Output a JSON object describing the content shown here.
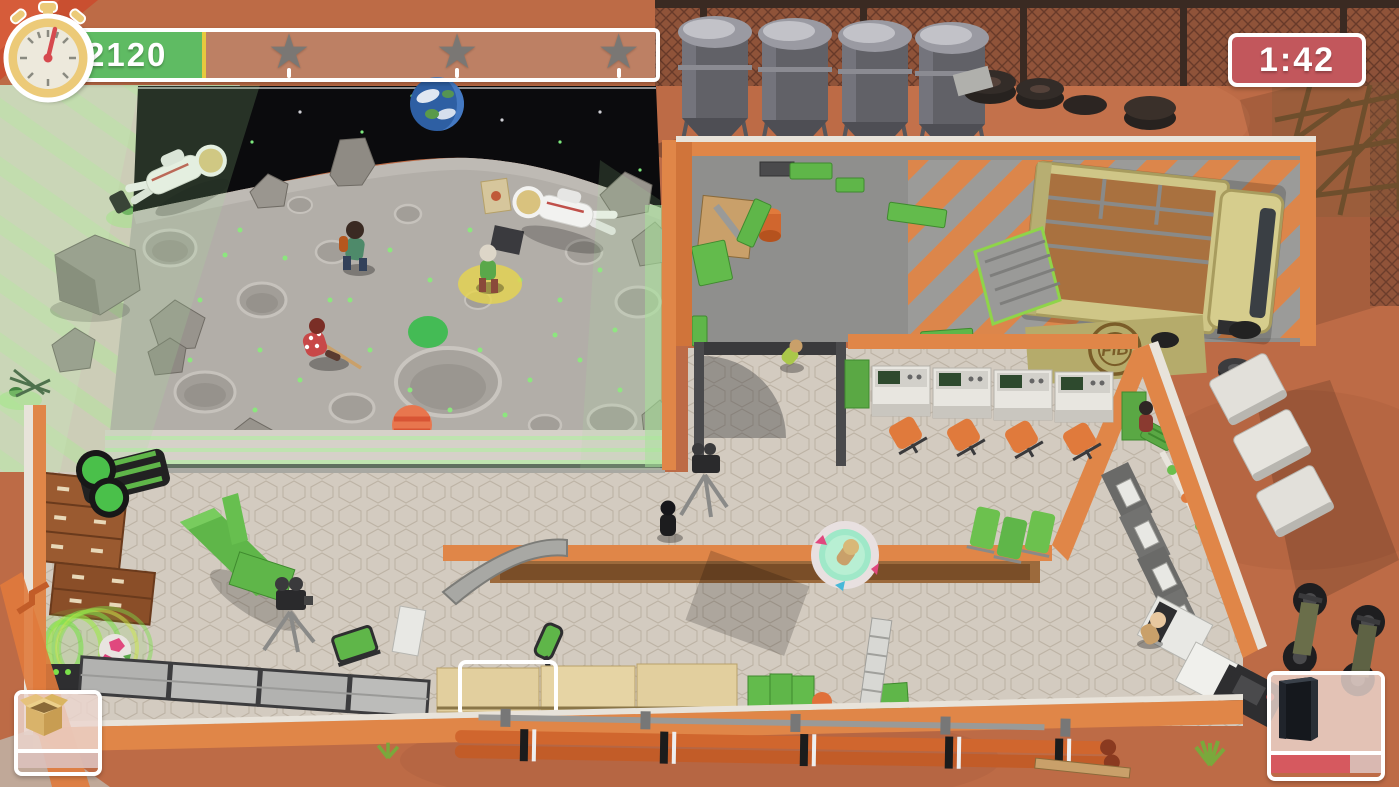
{
  "hud": {
    "money": {
      "value": "2120",
      "currency_symbol": "$",
      "fill_ratio": 0.27,
      "fill_color": "#5fbb63",
      "fill_edge_color": "#e6c93e",
      "coin_color": "#e2bd78"
    },
    "star_bar": {
      "star_glyph": "★",
      "stars_total": 3,
      "milestones": [
        0.41,
        0.68,
        0.94
      ],
      "star_color": "#787876"
    },
    "timer": {
      "value": "1:42",
      "bg_color": "#c2575c",
      "body_color": "#ecca78",
      "hand_color": "#d6494e"
    },
    "box_slot": {
      "icon": "cardboard-box-icon"
    },
    "item_slot": {
      "icon": "black-monolith-icon",
      "progress": 0.72,
      "progress_color": "#d6595f"
    }
  },
  "scene": {
    "truck_logo": "FIB",
    "palette": {
      "outdoor_ground": "#bd6b46",
      "studio_floor": "#d3cbc0",
      "concrete_floor": "#8f8f8d",
      "wall_orange": "#e08648",
      "prop_green": "#5fb649",
      "moon_surface": "#b2aea8",
      "space": "#0b0b0d",
      "green_glow": "#b4e8a4",
      "truck_khaki": "#cfc687",
      "hazard_gray": "#9c9c9a"
    }
  }
}
